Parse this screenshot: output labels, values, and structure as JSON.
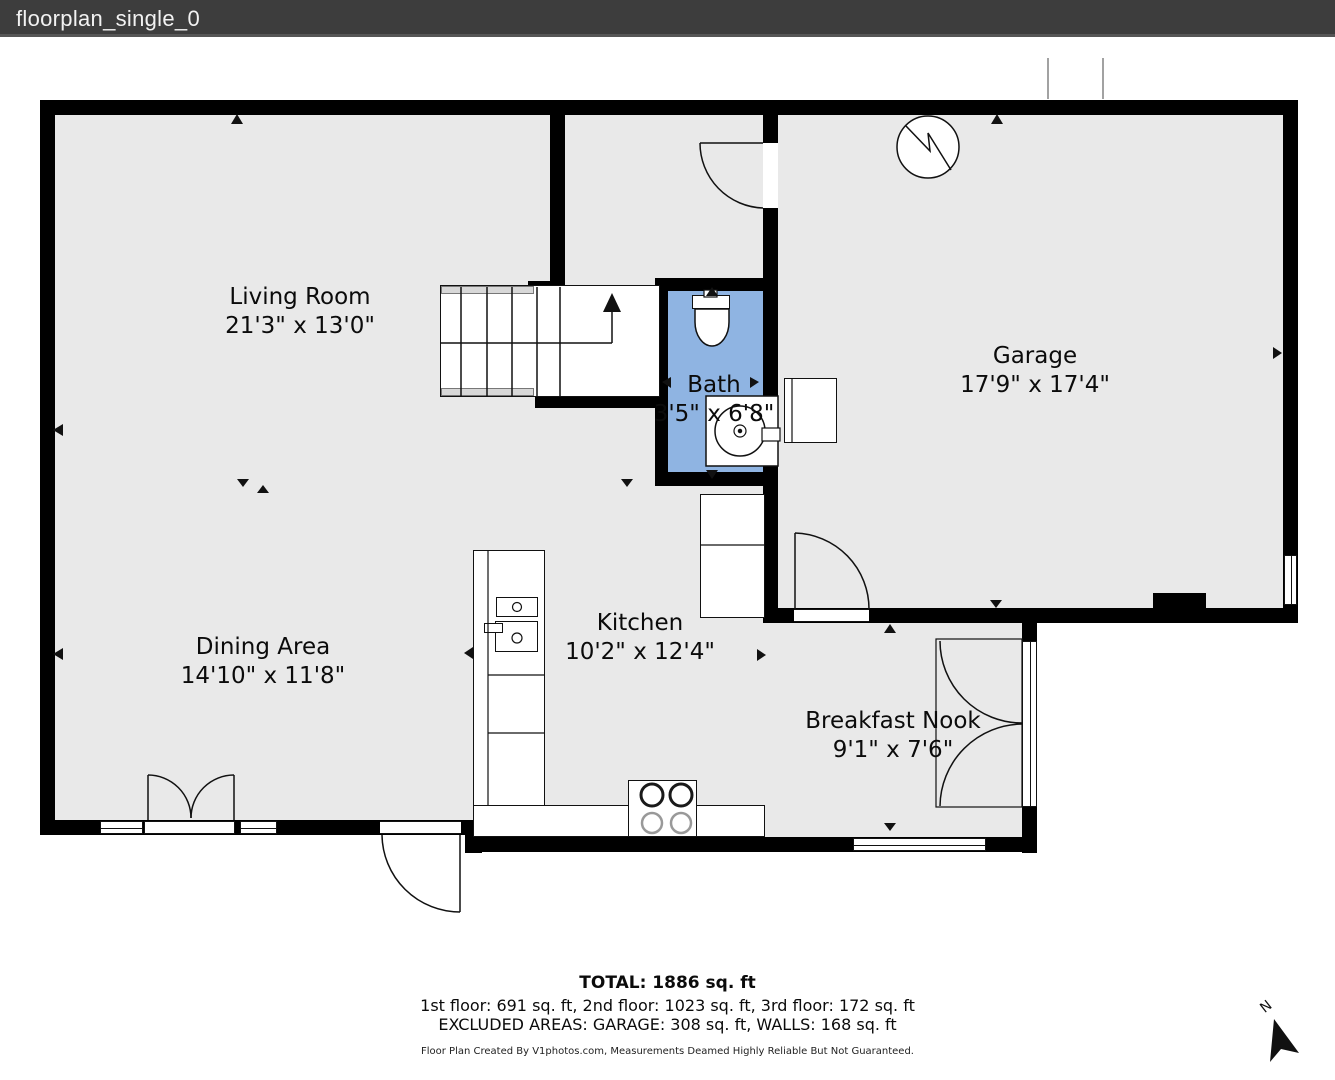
{
  "title_bar": {
    "title": "floorplan_single_0"
  },
  "colors": {
    "titlebar": "#3d3d3d",
    "floor": "#e9e9e9",
    "wall": "#000000",
    "bath": "#8fb4e2",
    "rail": "#d8d8d8"
  },
  "rooms": [
    {
      "id": "living-room",
      "name": "Living Room",
      "dims": "21'3\" x 13'0\""
    },
    {
      "id": "dining-area",
      "name": "Dining Area",
      "dims": "14'10\" x 11'8\""
    },
    {
      "id": "kitchen",
      "name": "Kitchen",
      "dims": "10'2\" x 12'4\""
    },
    {
      "id": "bath",
      "name": "Bath",
      "dims": "3'5\" x 6'8\""
    },
    {
      "id": "garage",
      "name": "Garage",
      "dims": "17'9\" x 17'4\""
    },
    {
      "id": "breakfast-nook",
      "name": "Breakfast Nook",
      "dims": "9'1\" x 7'6\""
    }
  ],
  "summary": {
    "total": "TOTAL: 1886 sq. ft",
    "floors": "1st floor: 691 sq. ft, 2nd floor: 1023 sq. ft, 3rd floor: 172 sq. ft",
    "excluded": "EXCLUDED AREAS: GARAGE: 308 sq. ft, WALLS: 168 sq. ft"
  },
  "disclaimer": "Floor Plan Created By V1photos.com, Measurements Deamed Highly Reliable But Not Guaranteed.",
  "compass": {
    "label": "N"
  }
}
